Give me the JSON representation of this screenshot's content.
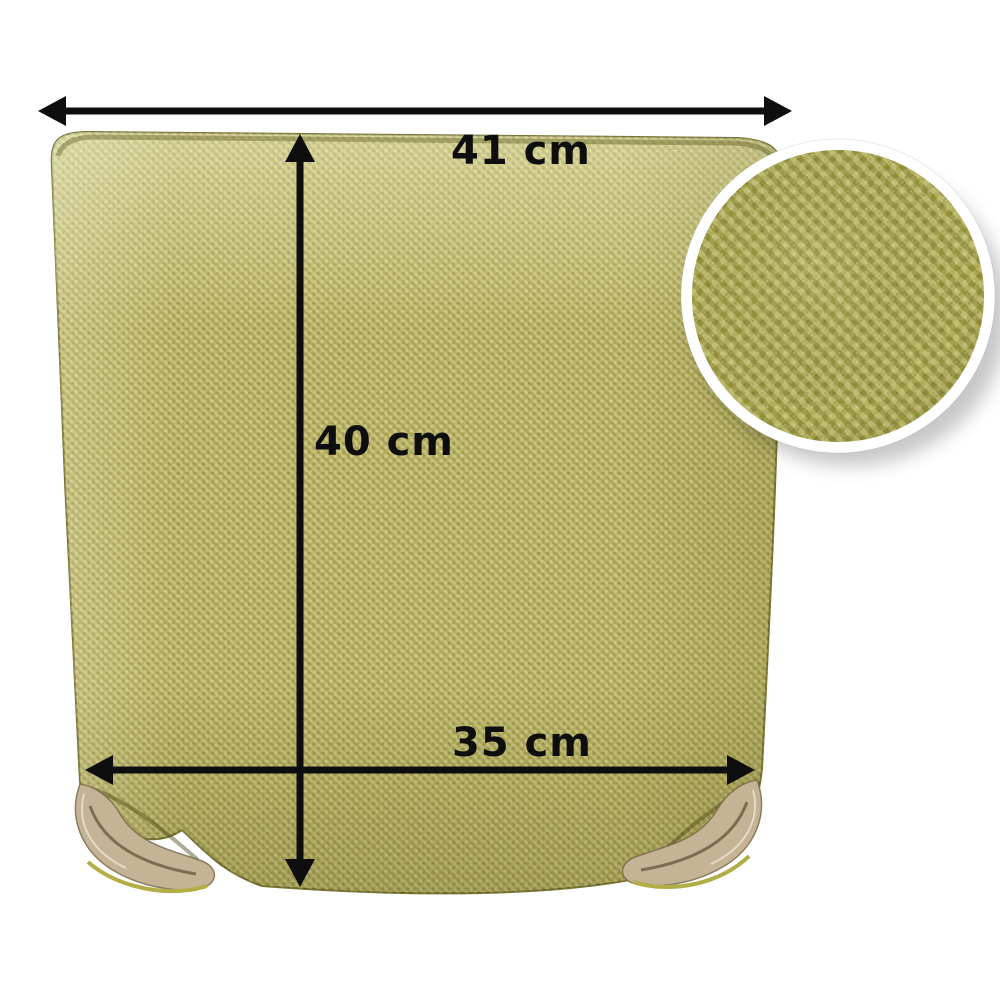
{
  "annotations": {
    "top_width_label": "41 cm",
    "height_label": "40 cm",
    "bottom_width_label": "35 cm"
  },
  "colors": {
    "background": "#ffffff",
    "arrow": "#0e0e0e",
    "label_text": "#0e0e0e",
    "fabric_base": "#bcb562",
    "inset_fabric": "#adaa4c",
    "inset_ring": "#ffffff",
    "strap": "#c4b394",
    "strap_piping": "#b2ad45"
  }
}
